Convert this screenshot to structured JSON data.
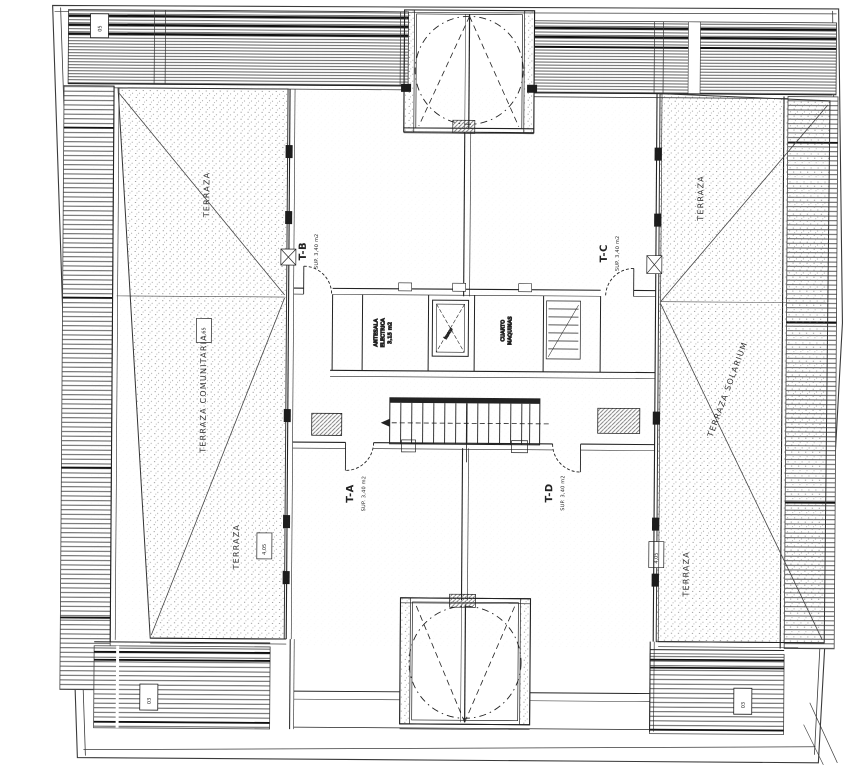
{
  "labels": {
    "terrace_left_top": "TERRAZA",
    "terrace_left_mid": "TERRAZA COMUNITARIA",
    "terrace_left_bottom": "TERRAZA",
    "terrace_right_top": "TERRAZA",
    "terrace_right_mid": "TERRAZA SOLARIUM",
    "terrace_right_bottom": "TERRAZA",
    "unit_tb": {
      "id": "T-B",
      "area": "SUP. 3,40 m2"
    },
    "unit_tc": {
      "id": "T-C",
      "area": "SUP. 3,40 m2"
    },
    "unit_ta": {
      "id": "T-A",
      "area": "SUP. 3,40 m2"
    },
    "unit_td": {
      "id": "T-D",
      "area": "SUP. 3,40 m2"
    },
    "room_antesala": {
      "l1": "ANTESALA",
      "l2": "ELECTRICA",
      "l3": "3,15 m2"
    },
    "room_maquinas": {
      "l1": "CUARTO",
      "l2": "MAQUINAS"
    },
    "shaft_note": "hueco",
    "tags": {
      "top_left": "05",
      "left_mid": "1,65",
      "left_low": "4,05",
      "right_low": "4,05",
      "bottom_left": "03",
      "bottom_right": "03"
    }
  },
  "colors": {
    "ink": "#2e2e2e",
    "paper": "#ffffff",
    "stipple": "#8a8a8a"
  }
}
